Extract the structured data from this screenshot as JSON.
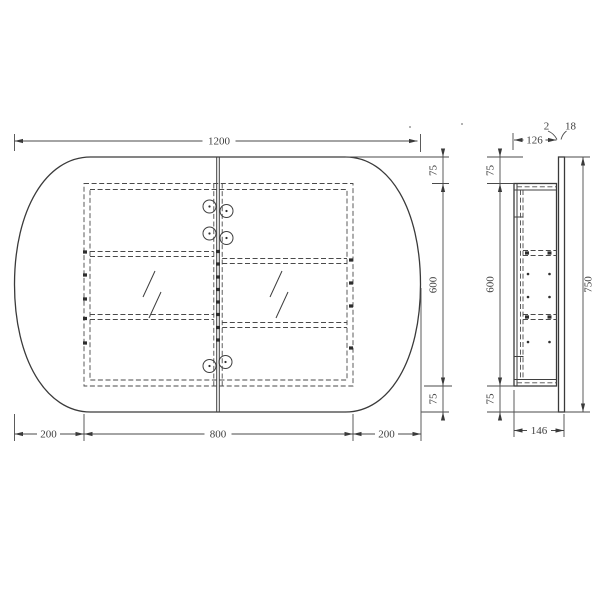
{
  "drawing": {
    "kind": "technical-drawing",
    "subject": "oval-mirror-cabinet",
    "views": {
      "front": "front-view",
      "side": "side-section-view"
    },
    "line_color": "#3f3f3f",
    "background": "#ffffff"
  },
  "dims_front": {
    "overall_width": "1200",
    "top_overhang": "75",
    "carcass_height": "600",
    "bottom_overhang": "75",
    "left_overhang": "200",
    "carcass_width": "800",
    "right_overhang": "200"
  },
  "dims_side": {
    "carcass_depth": "126",
    "gap": "2",
    "mirror_thickness": "18",
    "top_overhang": "75",
    "carcass_height": "600",
    "mirror_height": "750",
    "bottom_overhang": "75",
    "total_depth": "146"
  }
}
